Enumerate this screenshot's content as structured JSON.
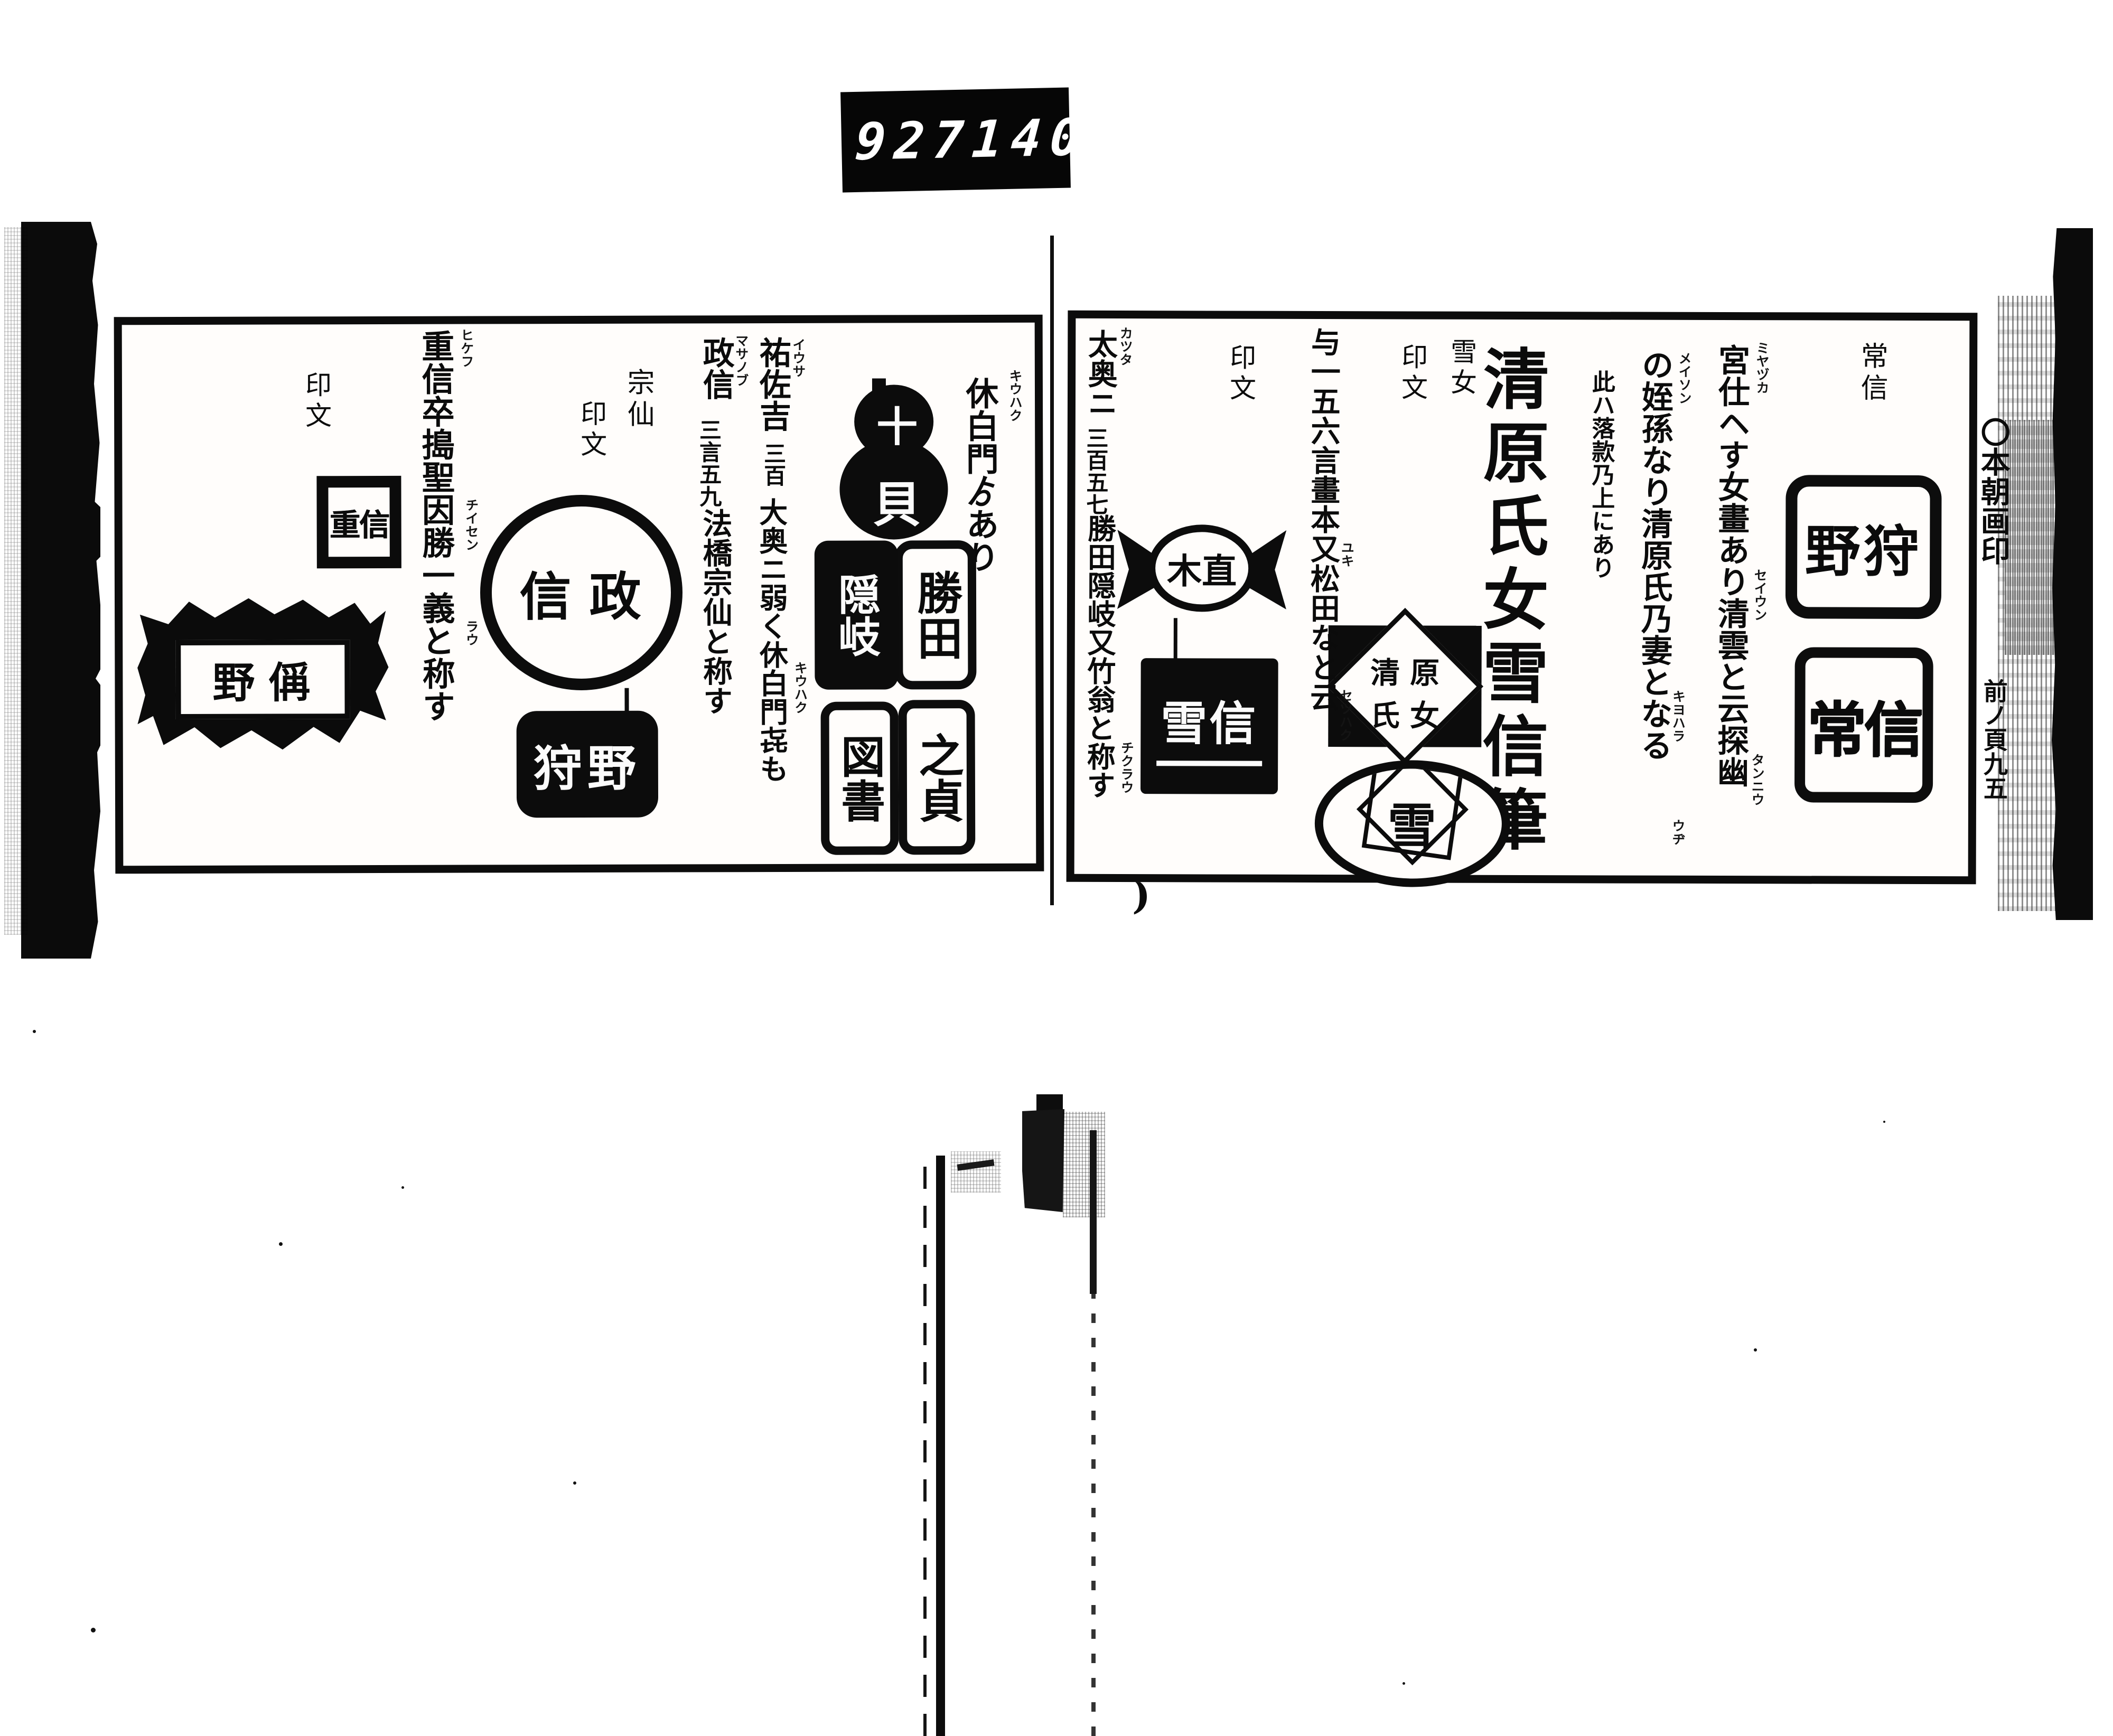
{
  "counter": {
    "reel": "927",
    "frame": "140."
  },
  "center_paren": ")",
  "right_margin": {
    "note_top": "〇本朝画印",
    "note_bottom": "前ノ頁九五"
  },
  "right_page": {
    "header": "常信",
    "seals": {
      "kano": {
        "style": "outline-rounded",
        "chars": [
          "野",
          "狩"
        ]
      },
      "tsunenobu": {
        "style": "outline-bold",
        "chars": [
          "常",
          "信"
        ]
      },
      "diamond": {
        "style": "diamond-on-black",
        "chars": [
          "清",
          "原",
          "氏",
          "女"
        ]
      },
      "yuki_circle": {
        "style": "circle-geometric",
        "chars": [
          "雪"
        ]
      },
      "winged": {
        "style": "winged-oval",
        "chars": [
          "木",
          "直"
        ]
      },
      "black_square": {
        "style": "white-on-black",
        "chars": [
          "雪",
          "信"
        ]
      }
    },
    "columns": {
      "c1": {
        "text": "宮仕ヘす女畫あり清雲と云探幽",
        "furigana": [
          "ミヤヅカ",
          "セイウン",
          "タンニウ"
        ]
      },
      "c2": {
        "text": "の姪孫なり清原氏乃妻となる",
        "furigana": [
          "メイソン",
          "キヨハラ",
          "ウヂ"
        ]
      },
      "c3_small": "此ハ落款乃上にあり",
      "title": "清原氏女雪信筆",
      "header_yukijo": "雪女",
      "header_inmon_1": "印文",
      "c4": {
        "text": "与一五六言畫本又松田なと云",
        "furigana": [
          "ユキ",
          "セツハク"
        ]
      },
      "header_inmon_2": "印文",
      "c5": {
        "pre": "太奥ニ",
        "num": "三百五七",
        "text": "勝田隠岐又竹翁と称す",
        "furigana": [
          "カツタ",
          "チクラウ"
        ]
      }
    }
  },
  "left_page": {
    "columns": {
      "c1": {
        "text": "休白門ゟあり",
        "furigana": "キウハク"
      },
      "c2": {
        "name": "祐佐吉",
        "num": "三百",
        "text": "大奥ニ弱く休白門㐂も",
        "furigana": [
          "イウサ",
          "キウハク"
        ]
      },
      "c3": {
        "name": "政信",
        "num": "三言五九",
        "text": "法橋宗仙と称す",
        "furigana": "マサノブ"
      },
      "header_sosen": "宗仙",
      "header_inmon_1": "印文",
      "header_inmon_2": "印文",
      "c4": {
        "text": "重信卒搗聖因勝一義と称す",
        "furigana": [
          "ヒケフ",
          "チイセン",
          "ラウ"
        ]
      }
    },
    "seals": {
      "gourd": {
        "style": "black-gourd",
        "chars": [
          "十",
          "貝"
        ]
      },
      "katsuta": {
        "style": "outline-rounded",
        "chars": [
          "勝",
          "田"
        ]
      },
      "oki": {
        "style": "white-on-black",
        "chars": [
          "隠",
          "岐"
        ]
      },
      "sadayoshi": {
        "style": "outline-rounded",
        "chars": [
          "之",
          "貞"
        ]
      },
      "tosho": {
        "style": "outline-rounded",
        "chars": [
          "図",
          "書"
        ]
      },
      "nobumasa_circle": {
        "style": "outline-circle",
        "chars": [
          "信",
          "政"
        ]
      },
      "kano_black": {
        "style": "white-on-black",
        "chars": [
          "狩",
          "野"
        ]
      },
      "square_geometric": {
        "style": "outline-square",
        "chars": [
          "重",
          "信"
        ]
      },
      "ornate": {
        "style": "spiky-cartouche",
        "chars": [
          "野",
          "偁"
        ]
      }
    }
  }
}
